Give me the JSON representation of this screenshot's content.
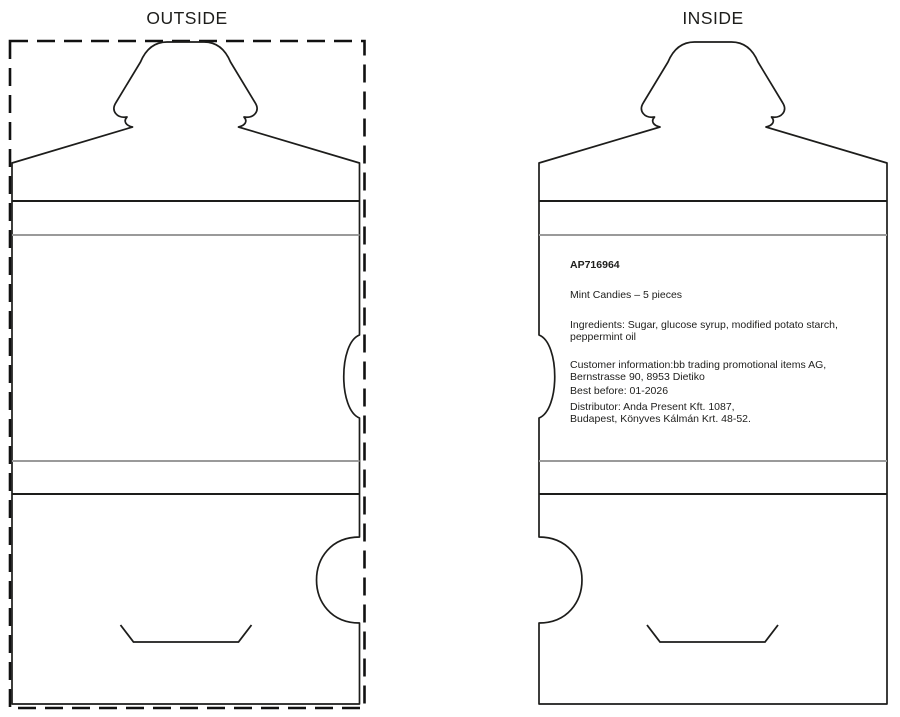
{
  "titles": {
    "outside": "OUTSIDE",
    "inside": "INSIDE"
  },
  "label": {
    "product_code": "AP716964",
    "product_name": "Mint Candies – 5 pieces",
    "ingredients": {
      "line1": "Ingredients: Sugar, glucose syrup, modified potato starch,",
      "line2": "peppermint oil"
    },
    "customer": {
      "line1": "Customer information:bb trading promotional items AG,",
      "line2": "Bernstrasse 90, 8953 Dietiko"
    },
    "best_before": "Best before: 01-2026",
    "distributor": {
      "line1": "Distributor: Anda Present Kft. 1087,",
      "line2": "Budapest, Könyves Kálmán Krt. 48-52."
    }
  },
  "colors": {
    "background": "#ffffff",
    "cut_line": "#1d1d1b",
    "dashed_box": "#111111",
    "fold_line_dark": "#1d1d1b",
    "fold_line_light": "#9a9a9a",
    "text": "#1d1d1b"
  }
}
